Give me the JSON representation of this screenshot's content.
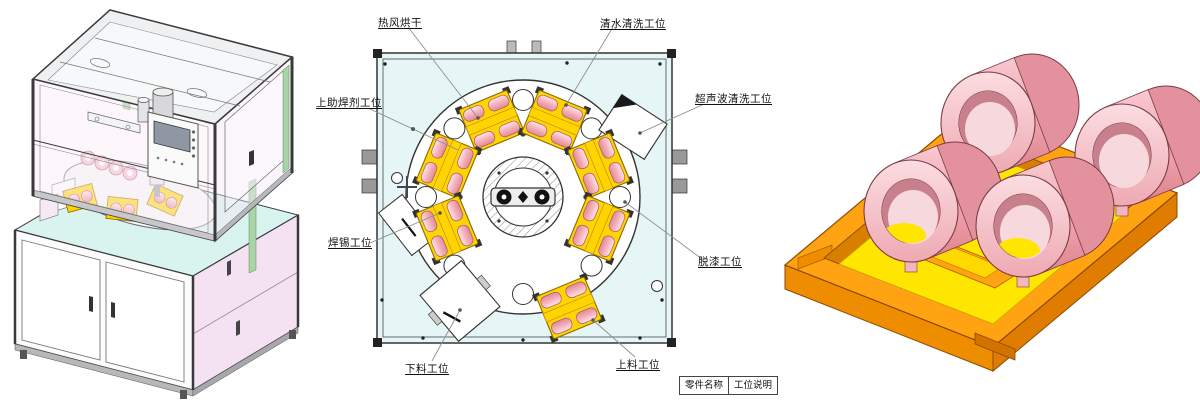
{
  "diagram": {
    "callouts": [
      {
        "id": "hot-air-drying",
        "text": "热风烘干"
      },
      {
        "id": "water-cleaning",
        "text": "清水清洗工位"
      },
      {
        "id": "flux-applying",
        "text": "上助焊剂工位"
      },
      {
        "id": "ultrasonic-cleaning",
        "text": "超声波清洗工位"
      },
      {
        "id": "soldering",
        "text": "焊锡工位"
      },
      {
        "id": "paint-stripping",
        "text": "脱漆工位"
      },
      {
        "id": "unloading",
        "text": "下料工位"
      },
      {
        "id": "loading",
        "text": "上料工位"
      }
    ],
    "title_block": {
      "part_name_header": "零件名称",
      "station_desc_header": "工位说明"
    }
  },
  "colors": {
    "diagram_background": "#e6f5f6",
    "drawing_line": "#333333",
    "leader_line": "#8f8f8f",
    "station_yellow": "#ffd400",
    "coil_pink": "#f6b8c1",
    "tray_orange": "#ffa313",
    "tray_recess_yellow": "#ffe600",
    "machine_green_trim": "#a8d4a8",
    "cabinet_side_pink": "#f4e2f2",
    "table_top_cyan": "#d9f3ef"
  }
}
